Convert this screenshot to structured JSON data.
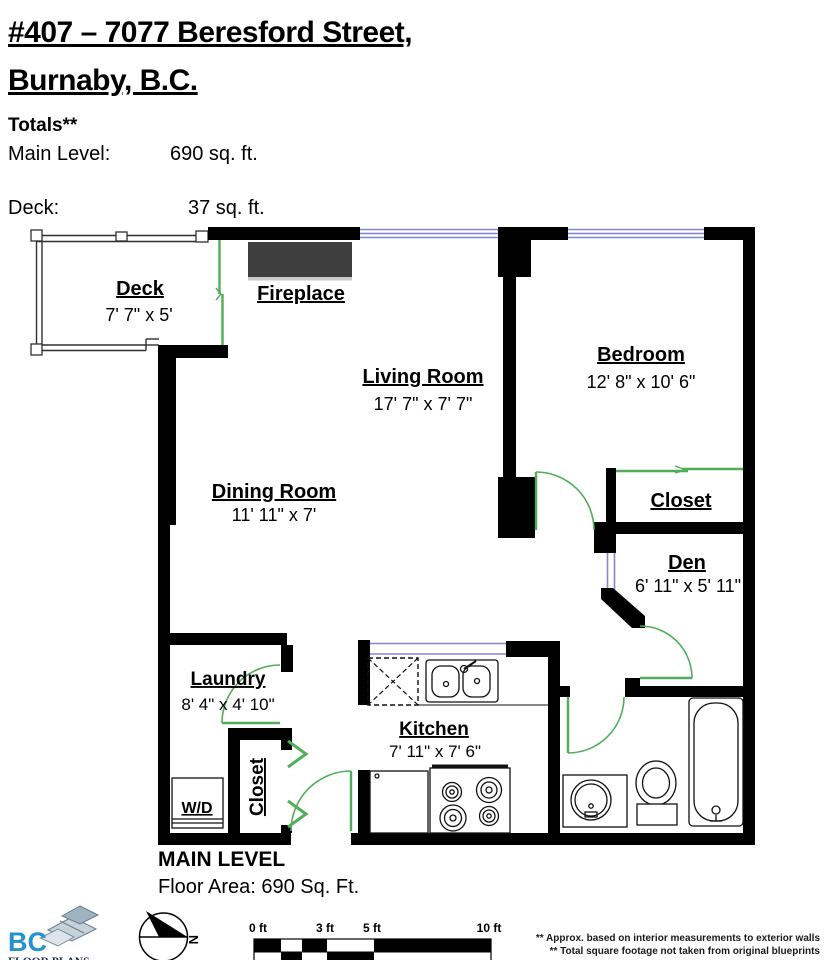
{
  "header": {
    "title_line1": "#407 – 7077 Beresford Street,",
    "title_line2": "Burnaby, B.C.",
    "totals_label": "Totals**",
    "main_level_label": "Main Level:",
    "main_level_value": "690 sq. ft.",
    "deck_label": "Deck:",
    "deck_value": "37 sq. ft."
  },
  "rooms": {
    "deck": {
      "name": "Deck",
      "dims": "7' 7\" x 5'"
    },
    "fireplace": {
      "name": "Fireplace"
    },
    "living_room": {
      "name": "Living Room",
      "dims": "17' 7\" x 7' 7\""
    },
    "bedroom": {
      "name": "Bedroom",
      "dims": "12' 8\" x 10' 6\""
    },
    "dining_room": {
      "name": "Dining Room",
      "dims": "11' 11\" x 7'"
    },
    "bedroom_closet": {
      "name": "Closet"
    },
    "den": {
      "name": "Den",
      "dims": "6' 11\" x 5' 11\""
    },
    "laundry": {
      "name": "Laundry",
      "dims": "8' 4\" x 4' 10\""
    },
    "kitchen": {
      "name": "Kitchen",
      "dims": "7' 11\" x 7' 6\""
    },
    "hall_closet": {
      "name": "Closet"
    },
    "washer_dryer": {
      "name": "W/D"
    }
  },
  "footer": {
    "level_title": "MAIN LEVEL",
    "floor_area": "Floor Area: 690 Sq. Ft.",
    "logo_text": "BC",
    "logo_subtext": "FLOOR PLANS",
    "compass_label": "N",
    "scale_labels": [
      "0 ft",
      "3 ft",
      "5 ft",
      "10 ft"
    ],
    "disclaimer_line1": "** Approx. based on interior measurements to exterior walls",
    "disclaimer_line2": "** Total square footage not taken from original blueprints"
  },
  "colors": {
    "wall": "#000000",
    "door_green": "#52ad5a",
    "window_blue": "#8585cf",
    "fireplace_gray": "#3e3e3e",
    "logo_blue": "#2492cf"
  }
}
